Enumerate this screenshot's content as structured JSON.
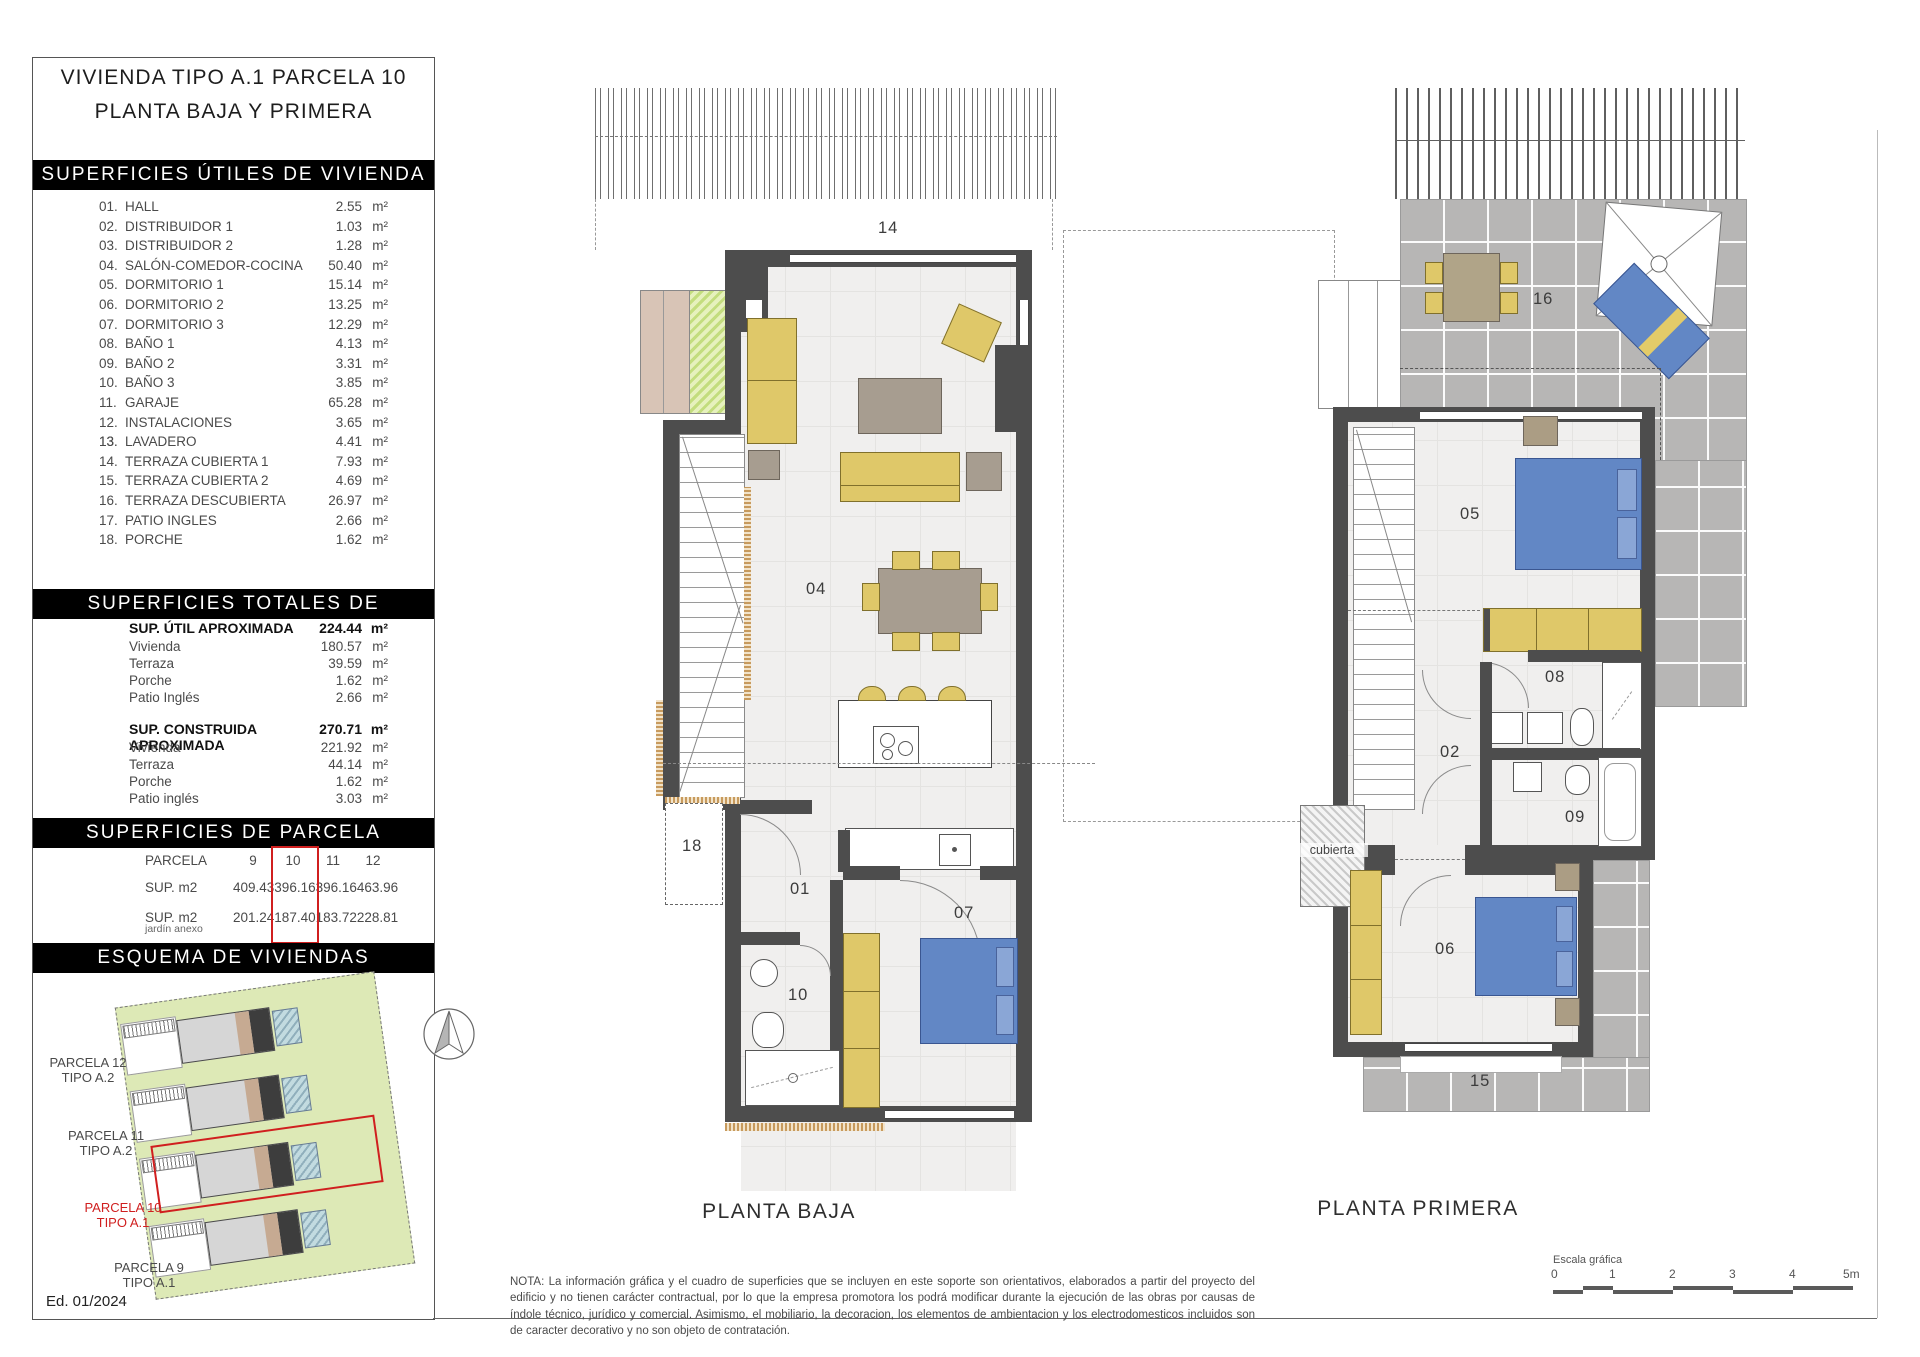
{
  "sheet": {
    "edition": "Ed. 01/2024"
  },
  "sidebar": {
    "title_line1": "VIVIENDA TIPO A.1 PARCELA 10",
    "title_line2": "PLANTA BAJA Y PRIMERA",
    "unit": "m²",
    "utiles": {
      "header": "SUPERFICIES ÚTILES DE VIVIENDA",
      "rows": [
        {
          "n": "01.",
          "label": "HALL",
          "v": "2.55"
        },
        {
          "n": "02.",
          "label": "DISTRIBUIDOR 1",
          "v": "1.03"
        },
        {
          "n": "03.",
          "label": "DISTRIBUIDOR 2",
          "v": "1.28"
        },
        {
          "n": "04.",
          "label": "SALÓN-COMEDOR-COCINA",
          "v": "50.40"
        },
        {
          "n": "05.",
          "label": "DORMITORIO 1",
          "v": "15.14"
        },
        {
          "n": "06.",
          "label": "DORMITORIO 2",
          "v": "13.25"
        },
        {
          "n": "07.",
          "label": "DORMITORIO 3",
          "v": "12.29"
        },
        {
          "n": "08.",
          "label": "BAÑO 1",
          "v": "4.13"
        },
        {
          "n": "09.",
          "label": "BAÑO 2",
          "v": "3.31"
        },
        {
          "n": "10.",
          "label": "BAÑO 3",
          "v": "3.85"
        },
        {
          "n": "11.",
          "label": "GARAJE",
          "v": "65.28"
        },
        {
          "n": "12.",
          "label": "INSTALACIONES",
          "v": "3.65"
        },
        {
          "n": "13.",
          "label": "LAVADERO",
          "v": "4.41"
        },
        {
          "n": "14.",
          "label": "TERRAZA CUBIERTA 1",
          "v": "7.93"
        },
        {
          "n": "15.",
          "label": "TERRAZA CUBIERTA 2",
          "v": "4.69"
        },
        {
          "n": "16.",
          "label": "TERRAZA DESCUBIERTA",
          "v": "26.97"
        },
        {
          "n": "17.",
          "label": "PATIO INGLES",
          "v": "2.66"
        },
        {
          "n": "18.",
          "label": "PORCHE",
          "v": "1.62"
        }
      ]
    },
    "totales": {
      "header": "SUPERFICIES TOTALES DE VIVIENDA",
      "groups": [
        {
          "title": "SUP. ÚTIL APROXIMADA",
          "value": "224.44",
          "rows": [
            {
              "label": "Vivienda",
              "v": "180.57"
            },
            {
              "label": "Terraza",
              "v": "39.59"
            },
            {
              "label": "Porche",
              "v": "1.62"
            },
            {
              "label": "Patio Inglés",
              "v": "2.66"
            }
          ]
        },
        {
          "title": "SUP. CONSTRUIDA APROXIMADA",
          "value": "270.71",
          "rows": [
            {
              "label": "Vivienda",
              "v": "221.92"
            },
            {
              "label": "Terraza",
              "v": "44.14"
            },
            {
              "label": "Porche",
              "v": "1.62"
            },
            {
              "label": "Patio inglés",
              "v": "3.03"
            }
          ]
        }
      ]
    },
    "parcela": {
      "header": "SUPERFICIES DE PARCELA",
      "row_parcela": "PARCELA",
      "row_sup": "SUP. m2",
      "row_jardin": "SUP. m2",
      "row_jardin_sub": "jardín anexo",
      "cols": [
        {
          "id": "9",
          "sup": "409.43",
          "jardin": "201.24"
        },
        {
          "id": "10",
          "sup": "396.16",
          "jardin": "187.40"
        },
        {
          "id": "11",
          "sup": "396.16",
          "jardin": "183.72"
        },
        {
          "id": "12",
          "sup": "463.96",
          "jardin": "228.81"
        }
      ]
    },
    "esquema": {
      "header": "ESQUEMA DE VIVIENDAS",
      "parcels": [
        {
          "l1": "PARCELA 12",
          "l2": "TIPO A.2"
        },
        {
          "l1": "PARCELA 11",
          "l2": "TIPO A.2"
        },
        {
          "l1": "PARCELA 10",
          "l2": "TIPO A.1"
        },
        {
          "l1": "PARCELA 9",
          "l2": "TIPO A.1"
        }
      ]
    }
  },
  "plans": {
    "baja": {
      "title": "PLANTA BAJA",
      "labels": {
        "terraza14": "14",
        "salon": "04",
        "porche18": "18",
        "hall": "01",
        "bano10": "10",
        "dorm07": "07"
      }
    },
    "primera": {
      "title": "PLANTA PRIMERA",
      "labels": {
        "terraza16": "16",
        "dorm05": "05",
        "bano08": "08",
        "dist02": "02",
        "bano09": "09",
        "dorm06": "06",
        "terraza15": "15",
        "cubierta": "cubierta"
      }
    }
  },
  "footer": {
    "note": "NOTA: La información gráfica y el cuadro de superficies que se incluyen en este soporte son orientativos, elaborados a partir del proyecto del edificio y no tienen carácter contractual, por lo que la empresa promotora los podrá modificar durante la ejecución de las obras por causas de índole técnico, jurídico y comercial. Asimismo, el mobiliario, la decoracion, los elementos de ambientacion y los electrodomesticos incluidos son de caracter decorativo y no son objeto de contratación.",
    "scale": {
      "title": "Escala gráfica",
      "ticks": [
        "0",
        "1",
        "2",
        "3",
        "4",
        "5m"
      ]
    }
  },
  "colors": {
    "accent_red": "#d01f1f",
    "wall": "#4d4d4d",
    "bed_blue": "#6287c5",
    "furniture_yellow": "#dfc869",
    "site_green": "#dde9b6",
    "terrace_gray": "#b7b6b5"
  }
}
